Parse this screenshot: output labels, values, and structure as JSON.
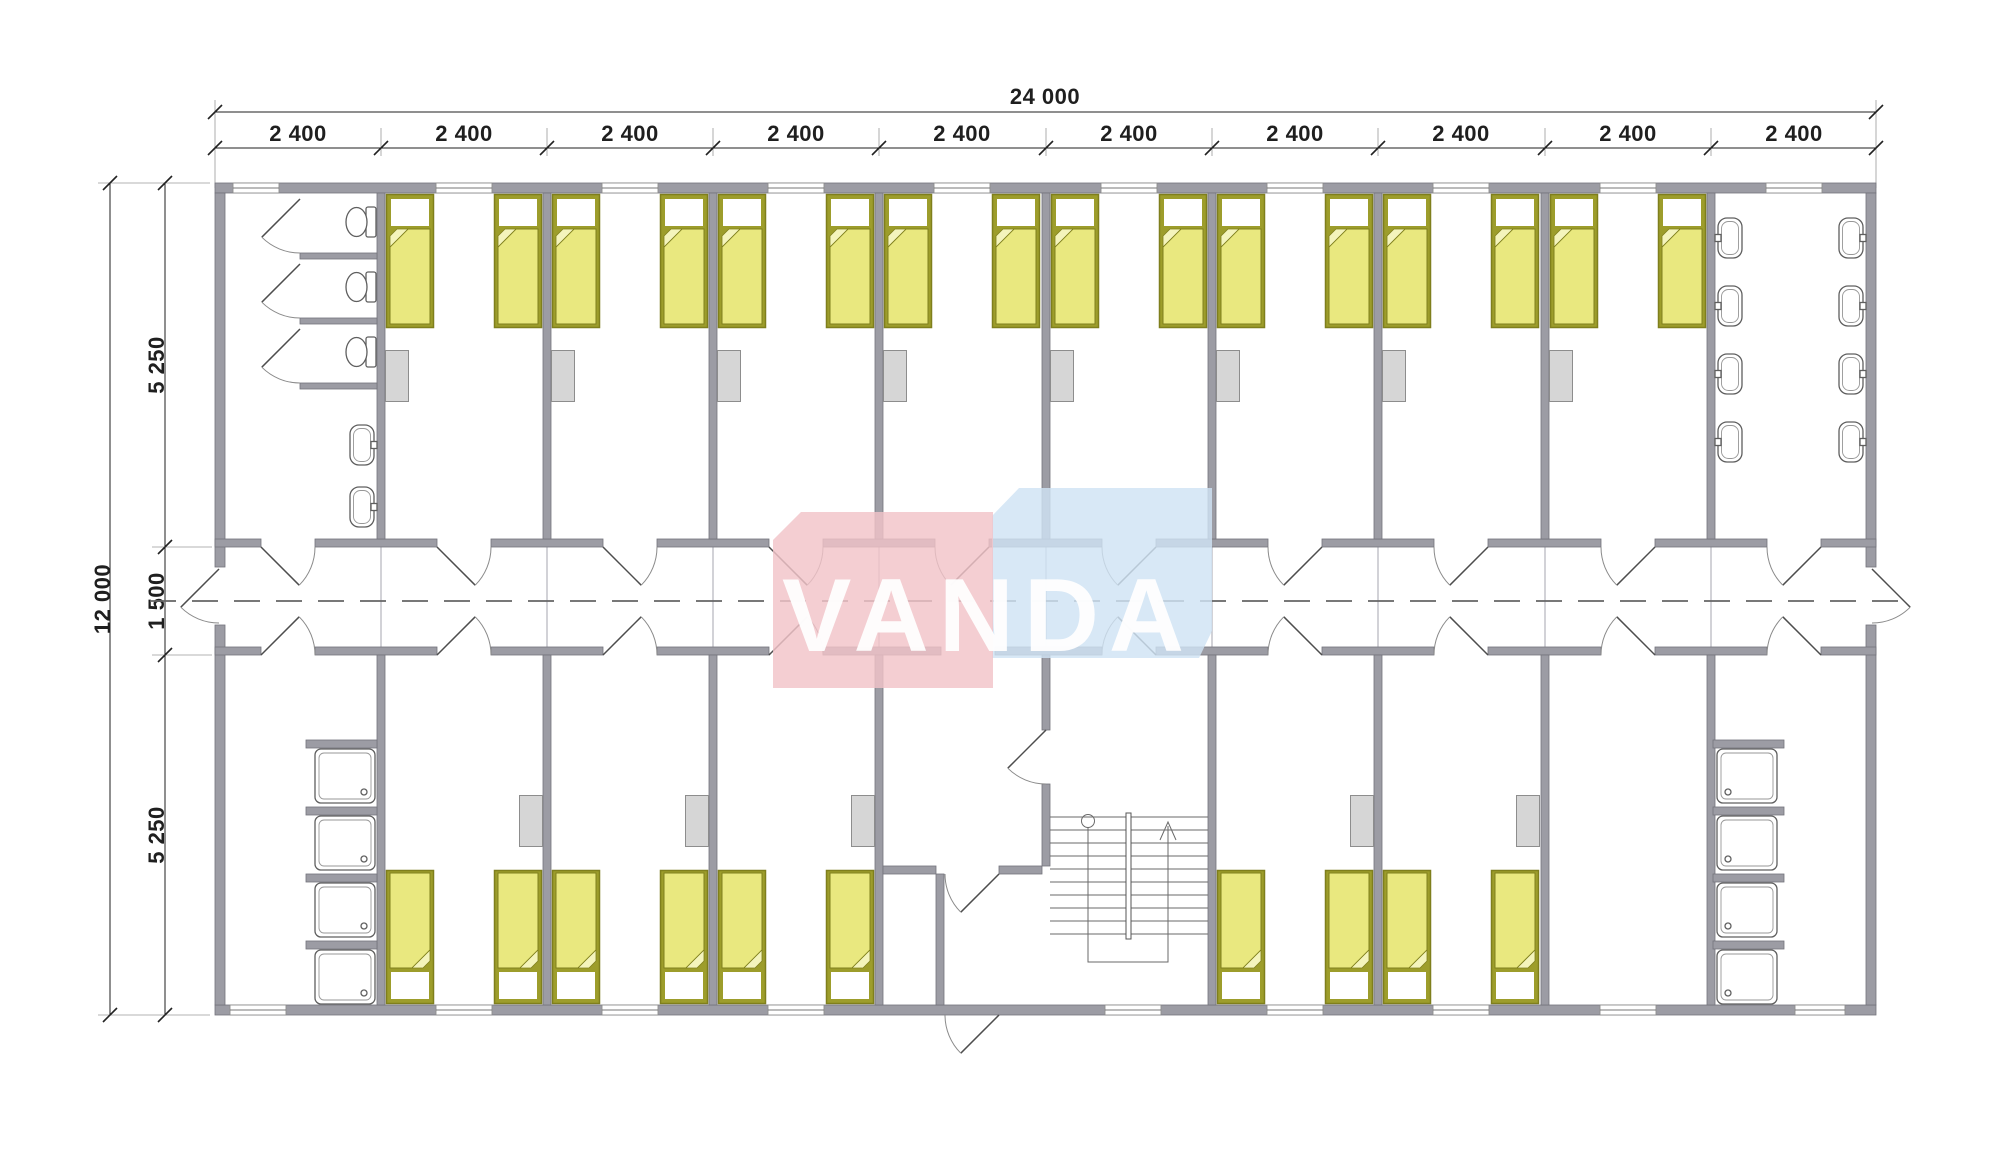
{
  "watermark": {
    "text": "VANDA"
  },
  "dimensions": {
    "top_total": "24 000",
    "top_segments": [
      "2 400",
      "2 400",
      "2 400",
      "2 400",
      "2 400",
      "2 400",
      "2 400",
      "2 400",
      "2 400",
      "2 400"
    ],
    "left_total": "12 000",
    "left_segments": [
      "5 250",
      "1 500",
      "5 250"
    ]
  },
  "colors": {
    "wall": "#9c9ca4",
    "wall-edge": "#73737c",
    "bed-frame": "#9d9d2b",
    "bed-frame-edge": "#7f7f1c",
    "bed-fill": "#e9e87f",
    "bed-fold": "#f4f4bc",
    "cabinet": "#d6d6d6",
    "fixture": "#5f5f5f",
    "dim": "#1f1f1f",
    "dash": "#666666",
    "wm-pink": "#f2c3c8",
    "wm-blue": "#cfe3f4",
    "wm-text": "#ffffff"
  },
  "inventory": {
    "modules": 10,
    "bedrooms": 13,
    "single_beds": 26,
    "wardrobes": 13,
    "wc_toilets": 3,
    "wc_basins": 2,
    "washroom_sinks": 8,
    "shower_trays": 8,
    "staircases": 1,
    "corridors": 1
  }
}
